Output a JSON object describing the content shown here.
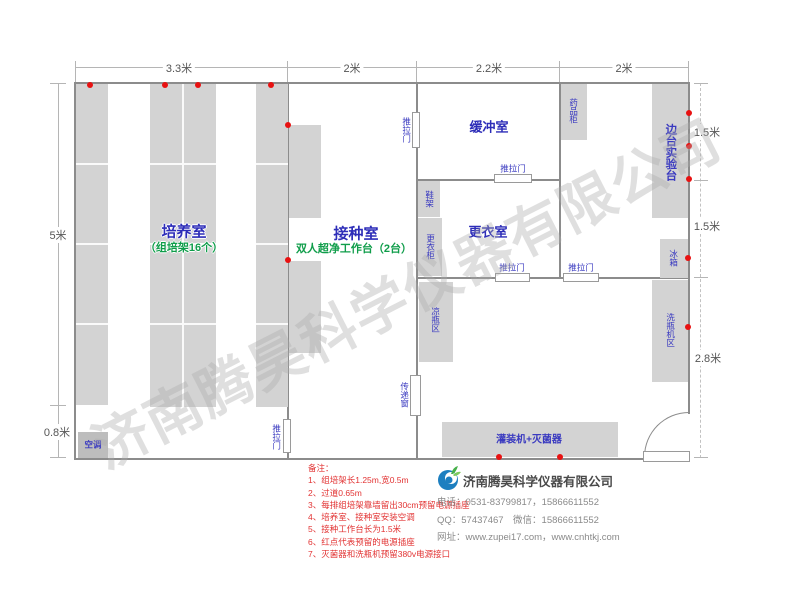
{
  "watermark": "济南腾昊科学仪器有限公司",
  "dimensions": {
    "top": [
      "3.3米",
      "2米",
      "2.2米",
      "2米"
    ],
    "left": [
      "5米",
      "0.8米"
    ],
    "right": [
      "1.5米",
      "1.5米",
      "2.8米"
    ]
  },
  "rooms": {
    "culture": {
      "name": "培养室",
      "sub": "（组培架16个）"
    },
    "inoculation": {
      "name": "接种室",
      "sub": "双人超净工作台（2台）"
    },
    "buffer": {
      "name": "缓冲室"
    },
    "changing": {
      "name": "更衣室"
    }
  },
  "fixtures": {
    "sliding_door": "推拉门",
    "air_conditioner": "空调",
    "shoe_rack": "鞋架",
    "wardrobe": "更衣柜",
    "medicine_cabinet": "药品柜",
    "side_lab_bench": "边台实验台",
    "fridge": "冰箱",
    "bottle_cooling_area": "凉瓶区",
    "transfer_window": "传递窗",
    "bottle_washer_area": "洗瓶机区",
    "filling_sterilizer": "灌装机+灭菌器"
  },
  "notes": {
    "title": "备注：",
    "items": [
      "1、组培架长1.25m,宽0.5m",
      "2、过道0.65m",
      "3、每排组培架靠墙留出30cm预留电源插座",
      "4、培养室、接种室安装空调",
      "5、接种工作台长为1.5米",
      "6、红点代表预留的电源插座",
      "7、灭菌器和洗瓶机预留380v电源接口"
    ]
  },
  "company": {
    "name": "济南腾昊科学仪器有限公司",
    "phone": "电话：0531-83799817，15866611552",
    "qq_wechat": "QQ：57437467　微信：15866611552",
    "website": "网址：www.zupei17.com，www.cnhtkj.com"
  },
  "colors": {
    "room_label_blue": "#2d2db8",
    "sub_label_green": "#0f9d4a",
    "note_red": "#e23333",
    "socket_dot_red": "#e81111",
    "wall_gray": "#8c8c8c",
    "furniture_gray": "#d3d3d3"
  }
}
